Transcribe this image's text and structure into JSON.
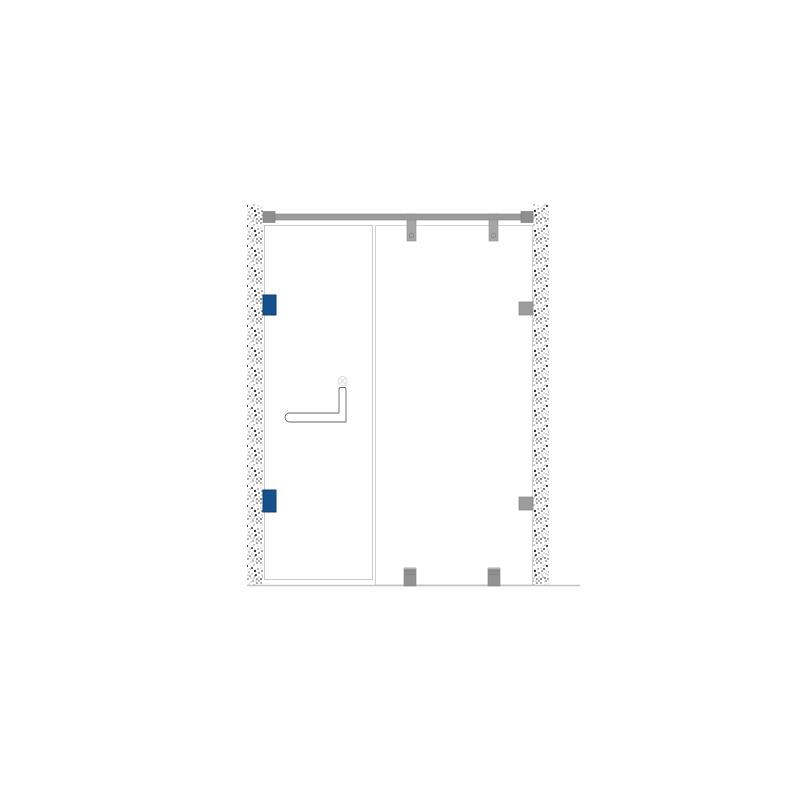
{
  "title": "Shower enclosure elevation drawing",
  "canvas": {
    "width": 800,
    "height": 800,
    "background": "#ffffff"
  },
  "colors": {
    "wall_base": "#fdfdfd",
    "bar_fill": "#9b9b9b",
    "bar_stroke": "#868686",
    "bracket_fill": "#8f8f8f",
    "bracket_stroke": "#787878",
    "top_clamp_fill": "#a6a6a6",
    "top_clamp_stroke": "#8c8c8c",
    "clamp_hole_stroke": "#858585",
    "panel_stroke_door": "#c9c9c9",
    "panel_stroke_fixed": "#d2d2d2",
    "panel_fill": "#ffffff",
    "hinge_fill": "#14518d",
    "hinge_stroke": "#0e3c6d",
    "wall_clamp_fill": "#9d9d9d",
    "wall_clamp_stroke": "#848484",
    "floor_clamp_fill": "#939393",
    "floor_clamp_stroke": "#7e7e7e",
    "floor_clamp_line": "#7a7a7a",
    "floor_clamp_cap": "#b5b5b5",
    "floor_line": "#c2c2c2",
    "handle_stroke": "#666666",
    "handle_fill": "#ffffff",
    "mark_stroke": "#d9d9d9"
  },
  "diagram": {
    "walls": [
      {
        "name": "wall-left",
        "x": 247,
        "y": 204,
        "w": 16,
        "h": 381
      },
      {
        "name": "wall-right",
        "x": 533,
        "y": 204,
        "w": 16,
        "h": 381
      }
    ],
    "panels": [
      {
        "name": "door-panel",
        "x": 264.5,
        "y": 225.5,
        "w": 108,
        "h": 354,
        "stroke_key": "panel_stroke_door"
      },
      {
        "name": "fixed-panel",
        "x": 375.5,
        "y": 225.5,
        "w": 157,
        "h": 359.5,
        "stroke_key": "panel_stroke_fixed"
      }
    ],
    "top_bar": {
      "name": "support-bar",
      "x": 263,
      "y": 214,
      "w": 270,
      "h": 6
    },
    "bar_brackets": [
      {
        "name": "support-bar-bracket-left",
        "x": 263,
        "y": 211.5,
        "w": 12,
        "h": 11
      },
      {
        "name": "support-bar-bracket-right",
        "x": 521,
        "y": 211.5,
        "w": 12,
        "h": 11
      }
    ],
    "top_clamps": [
      {
        "name": "bar-glass-clamp-1",
        "x": 407,
        "y": 214,
        "w": 9,
        "h": 27,
        "hole_cy": 235.5,
        "hole_r": 2.2
      },
      {
        "name": "bar-glass-clamp-2",
        "x": 489,
        "y": 214,
        "w": 9,
        "h": 27,
        "hole_cy": 235.5,
        "hole_r": 2.2
      }
    ],
    "hinges": [
      {
        "name": "door-hinge-top",
        "x": 263,
        "y": 295,
        "w": 13,
        "h": 20
      },
      {
        "name": "door-hinge-bottom",
        "x": 263,
        "y": 490,
        "w": 13,
        "h": 22
      }
    ],
    "wall_clamps": [
      {
        "name": "wall-glass-clamp-top",
        "x": 519,
        "y": 302,
        "w": 14,
        "h": 13
      },
      {
        "name": "wall-glass-clamp-bottom",
        "x": 519,
        "y": 497,
        "w": 14,
        "h": 13
      }
    ],
    "floor_clamps": [
      {
        "name": "floor-glass-clamp-1",
        "x": 404,
        "y": 568,
        "w": 12,
        "h": 18
      },
      {
        "name": "floor-glass-clamp-2",
        "x": 488,
        "y": 568,
        "w": 12,
        "h": 18
      }
    ],
    "floor_line": {
      "name": "floor-line",
      "x1": 247,
      "x2": 580,
      "y": 585.5,
      "width": 1.5
    },
    "handle": {
      "name": "door-handle",
      "stem_left": 339,
      "x_right": 346,
      "stem_top": 387.5,
      "bar_top": 413,
      "bar_bottom": 422,
      "x_left_center": 289.5,
      "cap_r": 4.5,
      "corner_r": 2,
      "mark": {
        "name": "handle-mount-mark",
        "cx": 342.5,
        "cy": 381,
        "r": 4.5
      }
    }
  }
}
